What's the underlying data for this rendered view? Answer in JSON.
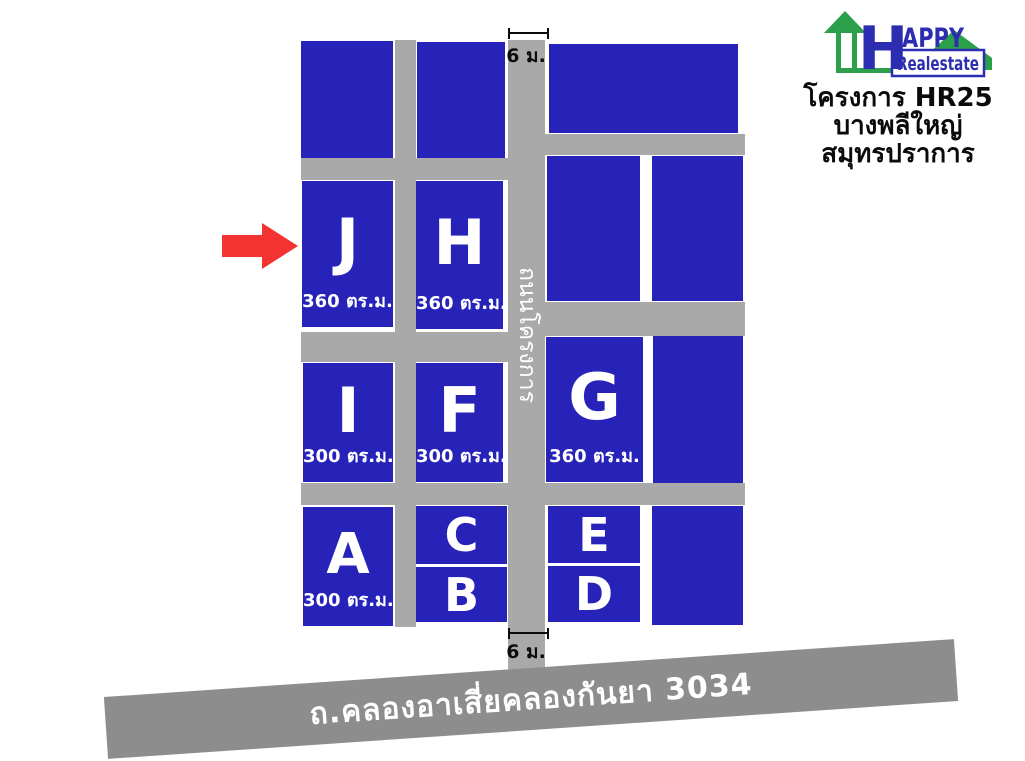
{
  "colors": {
    "plot": "#2823b8",
    "road": "#a9a9a9",
    "highway": "#8d8d8d",
    "arrow": "#f23331",
    "logo_green": "#2c9f4b",
    "logo_blue": "#2d2db1",
    "label_white": "#ffffff",
    "ink": "#0b0b0b"
  },
  "logo": {
    "word_h": "H",
    "word_appy": "APPY",
    "word_realestate": "Realestate"
  },
  "project": {
    "line1": "โครงการ HR25",
    "line2": "บางพลีใหญ่",
    "line3": "สมุทรปราการ"
  },
  "roads": {
    "internal_road_label": "ถนนโครงการ",
    "highway_label": "ถ.คลองอาเสี่ยคลองกันยา 3034",
    "road_width_top": "6 ม.",
    "road_width_bottom": "6 ม."
  },
  "plots": {
    "J": {
      "label": "J",
      "area": "360 ตร.ม."
    },
    "H": {
      "label": "H",
      "area": "360 ตร.ม."
    },
    "I": {
      "label": "I",
      "area": "300 ตร.ม."
    },
    "F": {
      "label": "F",
      "area": "300 ตร.ม."
    },
    "G": {
      "label": "G",
      "area": "360 ตร.ม."
    },
    "A": {
      "label": "A",
      "area": "300 ตร.ม."
    },
    "C": {
      "label": "C"
    },
    "B": {
      "label": "B"
    },
    "E": {
      "label": "E"
    },
    "D": {
      "label": "D"
    }
  }
}
